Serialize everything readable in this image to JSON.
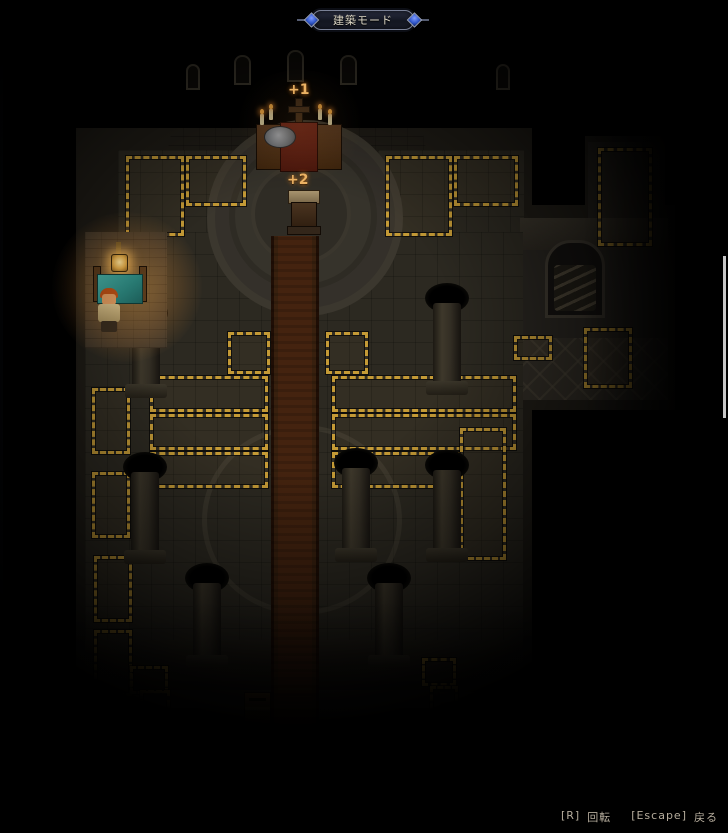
{
  "hud": {
    "mode_banner": "建築モード",
    "help": {
      "rotate_key": "[R]",
      "rotate_label": "回転",
      "back_key": "[Escape]",
      "back_label": "戻る"
    }
  },
  "scene": {
    "altar_bonus_label": "+1",
    "lectern_bonus_label": "+2",
    "objects": [
      "altar-with-cross-and-candles",
      "lectern-with-open-book",
      "church-workbench",
      "hanging-lantern",
      "player-character",
      "donation-box",
      "stairs-down-alcove",
      "stone-pillars",
      "red-carpet-nave",
      "build-placement-zones"
    ]
  },
  "icons": {
    "banner_gem": "diamond-gem",
    "cross": "latin-cross",
    "candle_flame": "flame",
    "lantern": "hanging-lamp"
  },
  "colors": {
    "hazard_dash": "#c49a36",
    "carpet": "#42220f",
    "bonus_text": "#eab163",
    "lamp_glow": "#ffb347",
    "banner_gem": "#2e55c8",
    "help_text": "#b5ac9c",
    "background": "#000000"
  }
}
